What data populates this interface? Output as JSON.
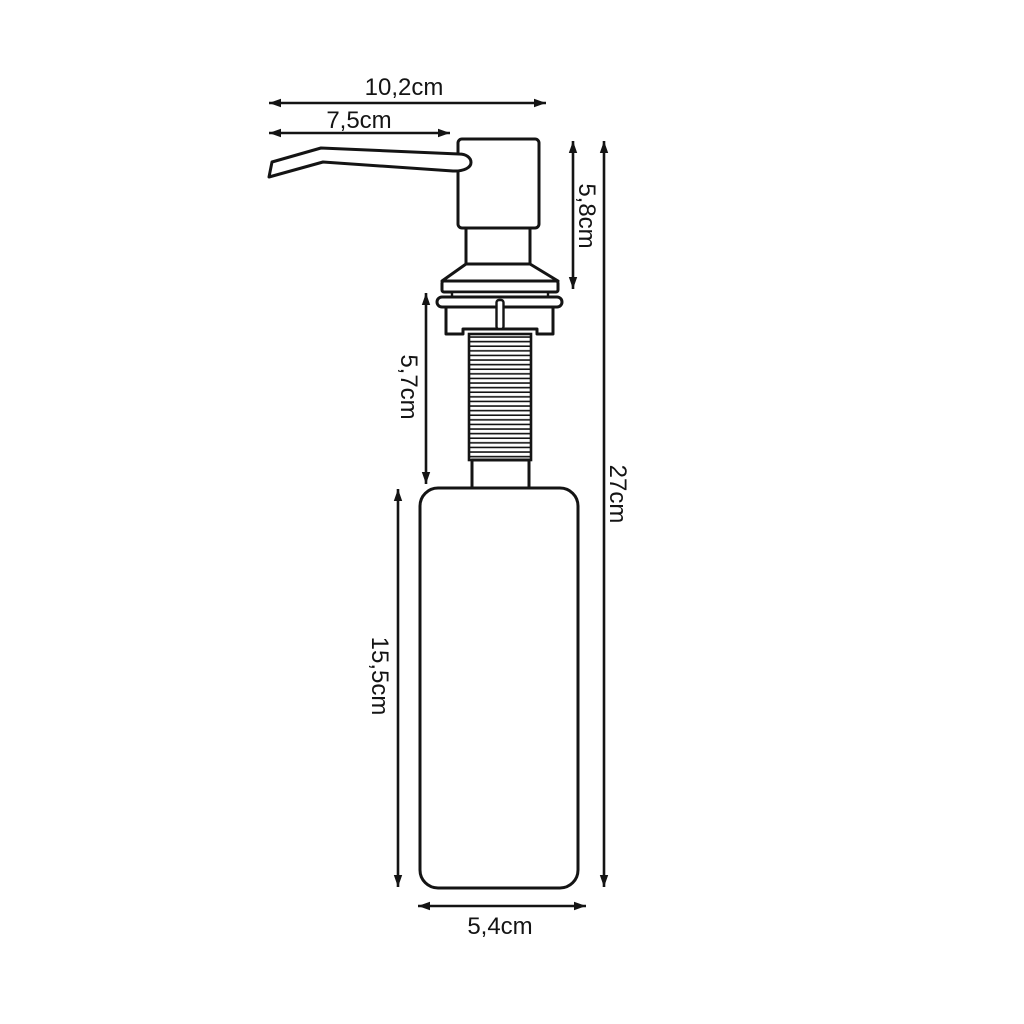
{
  "canvas": {
    "background": "#ffffff",
    "line_color": "#141414",
    "unit": "cm"
  },
  "dimension_labels": {
    "total_spout_width": "10,2cm",
    "spout_length": "7,5cm",
    "pump_head_height": "5,8cm",
    "thread_section_length": "5,7cm",
    "overall_height": "27cm",
    "bottle_height": "15,5cm",
    "bottle_width": "5,4cm"
  }
}
